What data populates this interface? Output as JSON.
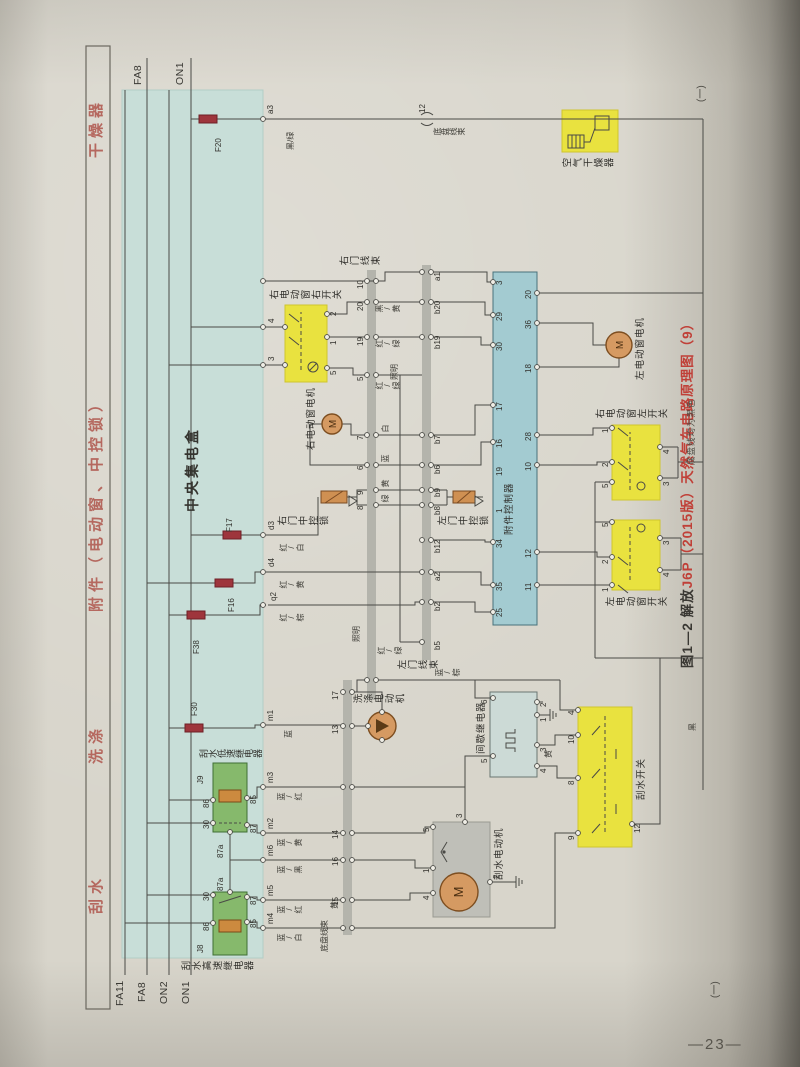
{
  "page": {
    "number": "—23—",
    "cont_top": "(一)",
    "cont_bottom": "(一)"
  },
  "caption": {
    "black": "图1—2  解放",
    "red": "J6P（2015版）天然气车电路原理图（9）"
  },
  "note": "底盘线均为黑色",
  "colors": {
    "paper": "#d8d5cb",
    "teal_box": "#c8ded8",
    "controller_box": "#a3cbd1",
    "relay_green": "#86b96c",
    "highlight_yellow": "#e9e23f",
    "motor_orange": "#d59a62",
    "fuse_red": "#9e353c",
    "header_pink": "#b5685f",
    "caption_red": "#c04038",
    "band_gray": "#b4b4ac"
  },
  "headers": [
    {
      "t": "刮水",
      "x": 96
    },
    {
      "t": "洗涤",
      "x": 246
    },
    {
      "t": "附件（电动窗、中控锁）",
      "x": 398
    },
    {
      "t": "干燥器",
      "x": 852
    }
  ],
  "bus_labels": [
    {
      "t": "FA11",
      "x": 4,
      "y": 30
    },
    {
      "t": "FA8",
      "x": 8,
      "y": 52
    },
    {
      "t": "ON2",
      "x": 6,
      "y": 74
    },
    {
      "t": "ON1",
      "x": 6,
      "y": 96
    },
    {
      "t": "FA8",
      "x": 925,
      "y": 48
    },
    {
      "t": "ON1",
      "x": 925,
      "y": 90
    }
  ],
  "components": [
    {
      "n": "central-junction-box",
      "x": 52,
      "y": 37,
      "w": 868,
      "h": 141,
      "f": "#c8ded8",
      "s": "#b2cdc6"
    },
    {
      "n": "accessory-controller",
      "x": 385,
      "y": 408,
      "w": 353,
      "h": 44,
      "f": "#a3cbd1",
      "s": "#48727b"
    },
    {
      "n": "relay-j9-box",
      "x": 178,
      "y": 128,
      "w": 69,
      "h": 34,
      "f": "#86b96c",
      "s": "#3f6f34"
    },
    {
      "n": "relay-j8-box",
      "x": 55,
      "y": 128,
      "w": 63,
      "h": 34,
      "f": "#86b96c",
      "s": "#3f6f34"
    },
    {
      "n": "air-dryer-box",
      "x": 858,
      "y": 477,
      "w": 42,
      "h": 56,
      "f": "#e9e23f",
      "s": "#cfc52e"
    },
    {
      "n": "right-window-right-switch-box",
      "x": 628,
      "y": 200,
      "w": 77,
      "h": 42,
      "f": "#e9e23f",
      "s": "#cfc52e"
    },
    {
      "n": "right-window-left-switch-box",
      "x": 510,
      "y": 527,
      "w": 75,
      "h": 48,
      "f": "#e9e23f",
      "s": "#cfc52e"
    },
    {
      "n": "left-window-switch-box",
      "x": 420,
      "y": 527,
      "w": 70,
      "h": 48,
      "f": "#e9e23f",
      "s": "#cfc52e"
    },
    {
      "n": "wiper-switch-box",
      "x": 163,
      "y": 493,
      "w": 140,
      "h": 54,
      "f": "#e9e23f",
      "s": "#cfc52e"
    },
    {
      "n": "intermittent-relay-box",
      "x": 233,
      "y": 405,
      "w": 85,
      "h": 47,
      "f": "#ccdad6",
      "s": "#6a7672"
    },
    {
      "n": "wiper-motor-box",
      "x": 93,
      "y": 348,
      "w": 95,
      "h": 57,
      "f": "#bfbfb8",
      "s": "#9a9a92"
    }
  ],
  "bands": [
    {
      "n": "connector-band-chassis",
      "x": 75,
      "y": 258,
      "w": 255,
      "h": 9
    },
    {
      "n": "connector-band-right-door",
      "x": 310,
      "y": 282,
      "w": 430,
      "h": 9
    },
    {
      "n": "connector-band-left-door",
      "x": 350,
      "y": 337,
      "w": 395,
      "h": 9
    }
  ],
  "fuses": [
    {
      "t": "F20",
      "x": 887,
      "y": 114,
      "lx": 858,
      "ly": 130
    },
    {
      "t": "F17",
      "x": 471,
      "y": 138,
      "lx": 478,
      "ly": 141
    },
    {
      "t": "F16",
      "x": 423,
      "y": 130,
      "lx": 398,
      "ly": 143
    },
    {
      "t": "F38",
      "x": 391,
      "y": 102,
      "lx": 356,
      "ly": 108
    },
    {
      "t": "F30",
      "x": 278,
      "y": 100,
      "lx": 294,
      "ly": 106
    }
  ],
  "motors": [
    {
      "n": "right-window-motor",
      "cx": 586,
      "cy": 247,
      "r": 10,
      "m": "M"
    },
    {
      "n": "left-window-motor",
      "cx": 665,
      "cy": 534,
      "r": 13,
      "m": "M"
    },
    {
      "n": "washer-motor",
      "cx": 284,
      "cy": 297,
      "r": 14,
      "m": ""
    },
    {
      "n": "wiper-motor",
      "cx": 118,
      "cy": 374,
      "r": 19,
      "m": "M"
    }
  ],
  "labels": [
    {
      "t": "中央集电盒",
      "x": 498,
      "y": 100,
      "c": "big",
      "n": "central-junction-box-label"
    },
    {
      "t": "附件控制器",
      "x": 475,
      "y": 420,
      "c": "comp-h",
      "n": "accessory-controller-label"
    },
    {
      "t": "空气干燥器",
      "x": 841,
      "y": 477,
      "c": "comp-v",
      "n": "air-dryer-label"
    },
    {
      "t": "右电动窗右开关",
      "x": 709,
      "y": 184,
      "c": "comp-v",
      "n": "rw-right-switch-label"
    },
    {
      "t": "右电动窗电机",
      "x": 560,
      "y": 222,
      "c": "comp-h",
      "n": "rw-motor-label"
    },
    {
      "t": "右门中控锁",
      "x": 483,
      "y": 192,
      "c": "comp-v",
      "n": "right-door-lock-label"
    },
    {
      "t": "左门中控锁",
      "x": 483,
      "y": 352,
      "c": "comp-v",
      "n": "left-door-lock-label"
    },
    {
      "t": "左电动窗电机",
      "x": 630,
      "y": 551,
      "c": "comp-h",
      "n": "lw-motor-label"
    },
    {
      "t": "右电动窗左开关",
      "x": 590,
      "y": 510,
      "c": "comp-v",
      "n": "rw-left-switch-label"
    },
    {
      "t": "左电动窗开关",
      "x": 402,
      "y": 520,
      "c": "comp-v",
      "n": "lw-switch-label"
    },
    {
      "t": "刮水开关",
      "x": 210,
      "y": 552,
      "c": "comp-h",
      "n": "wiper-switch-label"
    },
    {
      "t": "间歇继电器",
      "x": 256,
      "y": 392,
      "c": "comp-h",
      "n": "intermittent-relay-label"
    },
    {
      "t": "洗涤电动机",
      "x": 305,
      "y": 268,
      "c": "comp-v",
      "n": "washer-motor-label"
    },
    {
      "t": "刮水电动机",
      "x": 130,
      "y": 410,
      "c": "comp-h",
      "n": "wiper-motor-label"
    },
    {
      "t": "刮水低速继电器",
      "x": 251,
      "y": 114,
      "c": "comp-v2",
      "n": "relay-j9-label"
    },
    {
      "t": "刮水高速继电器",
      "x": 38,
      "y": 96,
      "c": "comp-v",
      "n": "relay-j8-label"
    },
    {
      "t": "J9",
      "x": 226,
      "y": 112,
      "c": "pin"
    },
    {
      "t": "J8",
      "x": 57,
      "y": 112,
      "c": "pin"
    },
    {
      "t": "右门线束",
      "x": 743,
      "y": 254,
      "c": "comp-v",
      "n": "right-door-harness-label"
    },
    {
      "t": "左门线束",
      "x": 339,
      "y": 312,
      "c": "comp-v",
      "n": "left-door-harness-label"
    },
    {
      "t": "底盘线束",
      "x": 58,
      "y": 236,
      "c": "wire-h",
      "n": "chassis-harness-label"
    },
    {
      "t": "底盘线束",
      "x": 874,
      "y": 348,
      "c": "wire-v",
      "n": "chassis-harness-label-2"
    },
    {
      "t": "a3",
      "x": 896,
      "y": 182,
      "c": "pin"
    },
    {
      "t": "12",
      "x": 897,
      "y": 334,
      "c": "pin"
    },
    {
      "t": "d3",
      "x": 480,
      "y": 183,
      "c": "pin"
    },
    {
      "t": "d4",
      "x": 443,
      "y": 183,
      "c": "pin"
    },
    {
      "t": "q2",
      "x": 409,
      "y": 185,
      "c": "pin"
    },
    {
      "t": "m1",
      "x": 289,
      "y": 182,
      "c": "pin"
    },
    {
      "t": "m3",
      "x": 227,
      "y": 182,
      "c": "pin"
    },
    {
      "t": "m2",
      "x": 181,
      "y": 182,
      "c": "pin"
    },
    {
      "t": "m6",
      "x": 154,
      "y": 182,
      "c": "pin"
    },
    {
      "t": "m5",
      "x": 114,
      "y": 182,
      "c": "pin"
    },
    {
      "t": "m4",
      "x": 86,
      "y": 182,
      "c": "pin"
    },
    {
      "t": "4",
      "x": 687,
      "y": 183,
      "c": "pin"
    },
    {
      "t": "3",
      "x": 649,
      "y": 183,
      "c": "pin"
    },
    {
      "t": "黑/绿",
      "x": 860,
      "y": 202,
      "c": "wire-h"
    },
    {
      "t": "红/白",
      "x": 458,
      "y": 194,
      "c": "wire-v"
    },
    {
      "t": "红/黄",
      "x": 421,
      "y": 194,
      "c": "wire-v"
    },
    {
      "t": "红/棕",
      "x": 388,
      "y": 194,
      "c": "wire-v"
    },
    {
      "t": "蓝",
      "x": 272,
      "y": 200,
      "c": "wire-h"
    },
    {
      "t": "蓝/红",
      "x": 209,
      "y": 192,
      "c": "wire-v"
    },
    {
      "t": "蓝/黄",
      "x": 163,
      "y": 192,
      "c": "wire-v"
    },
    {
      "t": "蓝/黑",
      "x": 136,
      "y": 192,
      "c": "wire-v"
    },
    {
      "t": "蓝/红",
      "x": 96,
      "y": 192,
      "c": "wire-v"
    },
    {
      "t": "蓝/白",
      "x": 68,
      "y": 192,
      "c": "wire-v"
    },
    {
      "t": "15",
      "x": 104,
      "y": 247,
      "c": "pin"
    },
    {
      "t": "16",
      "x": 144,
      "y": 247,
      "c": "pin"
    },
    {
      "t": "14",
      "x": 171,
      "y": 247,
      "c": "pin"
    },
    {
      "t": "13",
      "x": 276,
      "y": 247,
      "c": "pin"
    },
    {
      "t": "17",
      "x": 310,
      "y": 247,
      "c": "pin"
    },
    {
      "t": "黄",
      "x": 101,
      "y": 246,
      "c": "wire-h"
    },
    {
      "t": "8",
      "x": 500,
      "y": 272,
      "c": "pin"
    },
    {
      "t": "9",
      "x": 515,
      "y": 272,
      "c": "pin"
    },
    {
      "t": "6",
      "x": 540,
      "y": 272,
      "c": "pin"
    },
    {
      "t": "7",
      "x": 570,
      "y": 272,
      "c": "pin"
    },
    {
      "t": "5",
      "x": 629,
      "y": 272,
      "c": "pin"
    },
    {
      "t": "19",
      "x": 664,
      "y": 272,
      "c": "pin"
    },
    {
      "t": "20",
      "x": 699,
      "y": 272,
      "c": "pin"
    },
    {
      "t": "10",
      "x": 721,
      "y": 272,
      "c": "pin"
    },
    {
      "t": "绿",
      "x": 507,
      "y": 296,
      "c": "wire-v"
    },
    {
      "t": "黄",
      "x": 522,
      "y": 296,
      "c": "wire-v"
    },
    {
      "t": "蓝",
      "x": 547,
      "y": 296,
      "c": "wire-v"
    },
    {
      "t": "白",
      "x": 577,
      "y": 296,
      "c": "wire-v"
    },
    {
      "t": "红/绿",
      "x": 620,
      "y": 290,
      "c": "wire-v"
    },
    {
      "t": "照明",
      "x": 630,
      "y": 306,
      "c": "wire-h"
    },
    {
      "t": "红/绿",
      "x": 662,
      "y": 290,
      "c": "wire-v"
    },
    {
      "t": "黑/黄",
      "x": 697,
      "y": 290,
      "c": "wire-v"
    },
    {
      "t": "红/绿",
      "x": 355,
      "y": 292,
      "c": "wire-v"
    },
    {
      "t": "照明",
      "x": 368,
      "y": 268,
      "c": "wire-h"
    },
    {
      "t": "b5",
      "x": 360,
      "y": 349,
      "c": "pin"
    },
    {
      "t": "b2",
      "x": 399,
      "y": 349,
      "c": "pin"
    },
    {
      "t": "a2",
      "x": 429,
      "y": 349,
      "c": "pin"
    },
    {
      "t": "b12",
      "x": 457,
      "y": 349,
      "c": "pin"
    },
    {
      "t": "b8",
      "x": 495,
      "y": 349,
      "c": "pin"
    },
    {
      "t": "b9",
      "x": 513,
      "y": 349,
      "c": "pin"
    },
    {
      "t": "b6",
      "x": 536,
      "y": 349,
      "c": "pin"
    },
    {
      "t": "b7",
      "x": 566,
      "y": 349,
      "c": "pin"
    },
    {
      "t": "b19",
      "x": 661,
      "y": 349,
      "c": "pin"
    },
    {
      "t": "b20",
      "x": 696,
      "y": 349,
      "c": "pin"
    },
    {
      "t": "a1",
      "x": 729,
      "y": 349,
      "c": "pin"
    },
    {
      "t": "蓝/棕",
      "x": 333,
      "y": 350,
      "c": "wire-v"
    },
    {
      "t": "25",
      "x": 393,
      "y": 411,
      "c": "pin"
    },
    {
      "t": "35",
      "x": 419,
      "y": 411,
      "c": "pin"
    },
    {
      "t": "34",
      "x": 462,
      "y": 411,
      "c": "pin"
    },
    {
      "t": "1",
      "x": 497,
      "y": 411,
      "c": "pin"
    },
    {
      "t": "19",
      "x": 534,
      "y": 411,
      "c": "pin"
    },
    {
      "t": "16",
      "x": 562,
      "y": 411,
      "c": "pin"
    },
    {
      "t": "17",
      "x": 599,
      "y": 411,
      "c": "pin"
    },
    {
      "t": "30",
      "x": 659,
      "y": 411,
      "c": "pin"
    },
    {
      "t": "29",
      "x": 689,
      "y": 411,
      "c": "pin"
    },
    {
      "t": "3",
      "x": 725,
      "y": 411,
      "c": "pin"
    },
    {
      "t": "11",
      "x": 419,
      "y": 440,
      "c": "pin"
    },
    {
      "t": "12",
      "x": 452,
      "y": 440,
      "c": "pin"
    },
    {
      "t": "10",
      "x": 539,
      "y": 440,
      "c": "pin"
    },
    {
      "t": "28",
      "x": 569,
      "y": 440,
      "c": "pin"
    },
    {
      "t": "18",
      "x": 637,
      "y": 440,
      "c": "pin"
    },
    {
      "t": "36",
      "x": 681,
      "y": 440,
      "c": "pin"
    },
    {
      "t": "20",
      "x": 711,
      "y": 440,
      "c": "pin"
    },
    {
      "t": "2",
      "x": 694,
      "y": 245,
      "c": "pin"
    },
    {
      "t": "1",
      "x": 665,
      "y": 245,
      "c": "pin"
    },
    {
      "t": "5",
      "x": 635,
      "y": 245,
      "c": "pin"
    },
    {
      "t": "6",
      "x": 306,
      "y": 396,
      "c": "pin"
    },
    {
      "t": "5",
      "x": 247,
      "y": 396,
      "c": "pin"
    },
    {
      "t": "2",
      "x": 303,
      "y": 455,
      "c": "pin"
    },
    {
      "t": "1",
      "x": 288,
      "y": 455,
      "c": "pin"
    },
    {
      "t": "3",
      "x": 258,
      "y": 455,
      "c": "pin"
    },
    {
      "t": "4",
      "x": 237,
      "y": 455,
      "c": "pin"
    },
    {
      "t": "5",
      "x": 178,
      "y": 338,
      "c": "pin"
    },
    {
      "t": "1",
      "x": 137,
      "y": 338,
      "c": "pin"
    },
    {
      "t": "4",
      "x": 110,
      "y": 338,
      "c": "pin"
    },
    {
      "t": "3",
      "x": 192,
      "y": 371,
      "c": "pin"
    },
    {
      "t": "2",
      "x": 131,
      "y": 408,
      "c": "pin"
    },
    {
      "t": "4",
      "x": 295,
      "y": 483,
      "c": "pin"
    },
    {
      "t": "10",
      "x": 266,
      "y": 483,
      "c": "pin"
    },
    {
      "t": "8",
      "x": 225,
      "y": 483,
      "c": "pin"
    },
    {
      "t": "9",
      "x": 170,
      "y": 483,
      "c": "pin"
    },
    {
      "t": "12",
      "x": 177,
      "y": 549,
      "c": "pin"
    },
    {
      "t": "黄",
      "x": 252,
      "y": 460,
      "c": "wire-h"
    },
    {
      "t": "1",
      "x": 577,
      "y": 517,
      "c": "pin"
    },
    {
      "t": "2",
      "x": 543,
      "y": 517,
      "c": "pin"
    },
    {
      "t": "5",
      "x": 522,
      "y": 517,
      "c": "pin"
    },
    {
      "t": "4",
      "x": 556,
      "y": 578,
      "c": "pin"
    },
    {
      "t": "3",
      "x": 524,
      "y": 578,
      "c": "pin"
    },
    {
      "t": "5",
      "x": 483,
      "y": 517,
      "c": "pin"
    },
    {
      "t": "2",
      "x": 446,
      "y": 517,
      "c": "pin"
    },
    {
      "t": "1",
      "x": 418,
      "y": 517,
      "c": "pin"
    },
    {
      "t": "3",
      "x": 465,
      "y": 578,
      "c": "pin"
    },
    {
      "t": "4",
      "x": 433,
      "y": 578,
      "c": "pin"
    },
    {
      "t": "30",
      "x": 181,
      "y": 118,
      "c": "pin"
    },
    {
      "t": "86",
      "x": 202,
      "y": 118,
      "c": "pin"
    },
    {
      "t": "87",
      "x": 177,
      "y": 165,
      "c": "pin"
    },
    {
      "t": "85",
      "x": 206,
      "y": 165,
      "c": "pin"
    },
    {
      "t": "87a",
      "x": 152,
      "y": 132,
      "c": "pin"
    },
    {
      "t": "30",
      "x": 109,
      "y": 118,
      "c": "pin"
    },
    {
      "t": "86",
      "x": 79,
      "y": 118,
      "c": "pin"
    },
    {
      "t": "87",
      "x": 105,
      "y": 165,
      "c": "pin"
    },
    {
      "t": "85",
      "x": 82,
      "y": 165,
      "c": "pin"
    },
    {
      "t": "87a",
      "x": 119,
      "y": 132,
      "c": "pin"
    },
    {
      "t": "黑",
      "x": 279,
      "y": 604,
      "c": "wire-h"
    }
  ]
}
